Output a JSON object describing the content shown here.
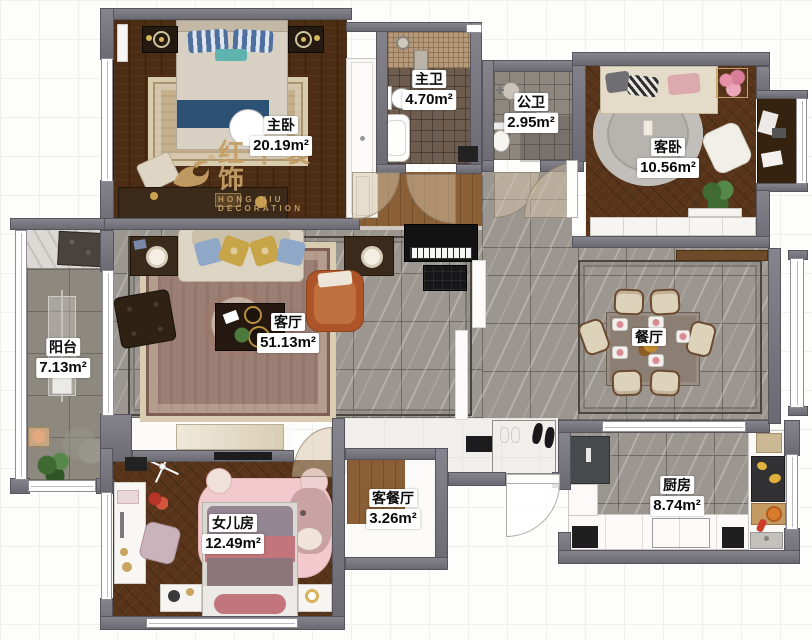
{
  "watermark": {
    "brand": "红牛装饰",
    "subtitle": "HONG NIU DECORATION",
    "registered": "®"
  },
  "rooms": [
    {
      "id": "master-bedroom",
      "name": "主卧",
      "area": "20.19m²"
    },
    {
      "id": "master-bath",
      "name": "主卫",
      "area": "4.70m²"
    },
    {
      "id": "public-bath",
      "name": "公卫",
      "area": "2.95m²"
    },
    {
      "id": "guest-bedroom",
      "name": "客卧",
      "area": "10.56m²"
    },
    {
      "id": "balcony",
      "name": "阳台",
      "area": "7.13m²"
    },
    {
      "id": "living-room",
      "name": "客厅",
      "area": "51.13m²"
    },
    {
      "id": "dining-room",
      "name": "餐厅",
      "area": ""
    },
    {
      "id": "daughter-room",
      "name": "女儿房",
      "area": "12.49m²"
    },
    {
      "id": "hallway",
      "name": "客餐厅",
      "area": "3.26m²"
    },
    {
      "id": "kitchen",
      "name": "厨房",
      "area": "8.74m²"
    }
  ],
  "colors": {
    "wall": "#75737a",
    "wood_dark": "#4b2d15",
    "wood_guest": "#57341a",
    "marble_tile": "#9c9690",
    "balcony_tile": "#8e897f",
    "accent_gold": "#c59f66",
    "label_bg": "#ffffff",
    "label_text": "#0a0a0a",
    "sofa_cream": "#ddd5c4",
    "armchair_orange": "#ad5428",
    "cat_rug_pink": "#f2c9cc"
  }
}
